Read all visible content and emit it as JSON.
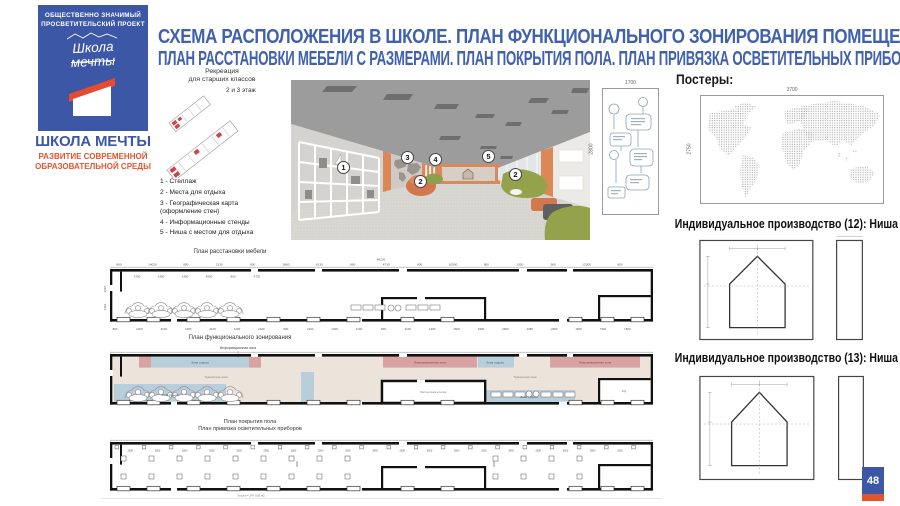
{
  "logo": {
    "tagline_line1": "ОБЩЕСТВЕННО ЗНАЧИМЫЙ",
    "tagline_line2": "ПРОСВЕТИТЕЛЬСКИЙ ПРОЕКТ",
    "script_line1": "Школа",
    "script_line2": "мечты",
    "brand_name": "ШКОЛА МЕЧТЫ",
    "brand_sub_line1": "РАЗВИТИЕ СОВРЕМЕННОЙ",
    "brand_sub_line2": "ОБРАЗОВАТЕЛЬНОЙ СРЕДЫ"
  },
  "title": {
    "line1": "СХЕМА РАСПОЛОЖЕНИЯ В ШКОЛЕ. ПЛАН ФУНКЦИОНАЛЬНОГО ЗОНИРОВАНИЯ ПОМЕЩЕНИЯ.",
    "line2": "ПЛАН РАССТАНОВКИ МЕБЕЛИ С РАЗМЕРАМИ. ПЛАН ПОКРЫТИЯ ПОЛА. ПЛАН ПРИВЯЗКА ОСВЕТИТЕЛЬНЫХ ПРИБОРОВ"
  },
  "recreation": {
    "title_line1": "Рекреация",
    "title_line2": "для старших классов",
    "floors_note": "2 и 3 этаж",
    "legend": [
      "1 - Стеллаж",
      "2 - Места для отдыха",
      "3 - Географическая карта\n(оформление стен)",
      "4 - Информационные стенды",
      "5 - Ниша с местом для отдыха"
    ]
  },
  "render_view": {
    "markers": [
      "1",
      "2",
      "3",
      "4",
      "5",
      "2"
    ]
  },
  "posters": {
    "heading": "Постеры:",
    "poster1_width": "1700",
    "poster1_height": "2800",
    "poster2_width": "3700",
    "poster2_height": "2750"
  },
  "production": {
    "title12": "Индивидуальное производство (12): Ниша",
    "title13": "Индивидуальное производство (13): Ниша"
  },
  "plans": {
    "furniture": {
      "title": "План расстановки мебели",
      "total_dim": "46230",
      "dims_top": [
        "800",
        "14020",
        "800",
        "2130",
        "800",
        "1860",
        "6130",
        "800",
        "4730",
        "800",
        "10500",
        "900",
        "1000",
        "900",
        "12000",
        "800"
      ],
      "dims_sub": [
        "3700",
        "1400",
        "1400",
        "4000",
        "800",
        "4720"
      ],
      "dims_left": [
        "3610",
        "3310"
      ],
      "dims_bottom": [
        "800",
        "1200",
        "2100",
        "1300",
        "2100",
        "1200",
        "2100",
        "500",
        "2100",
        "1200",
        "2100",
        "500",
        "2100",
        "1200",
        "1500",
        "2300",
        "2600",
        "2050",
        "2900",
        "1500",
        "7300",
        "1500"
      ]
    },
    "zoning": {
      "title": "План функционального зонирования",
      "callout": "Информационная зона",
      "zone_info": "Информационная зона",
      "zone_rest": "Зона отдыха",
      "zone_transit": "Транзитная зона",
      "zone_stairs": "Лестничная клетка",
      "zone_wc": "С/у"
    },
    "flooring": {
      "title1": "План покрытия пола",
      "title2": "План привязка осветительных приборов",
      "dim_label": "2500",
      "area_note": "Sпола = 247.026 м2"
    }
  },
  "slide": {
    "page_number": "48"
  },
  "colors": {
    "brand_blue": "#3c57a6",
    "brand_red": "#e2552e",
    "title_blue": "#4061ae",
    "zone_info_pink": "#d9a3a4",
    "zone_rest_blue": "#b9cedb",
    "zone_transit_beige": "#ece4da",
    "accent_orange": "#dd8757"
  }
}
